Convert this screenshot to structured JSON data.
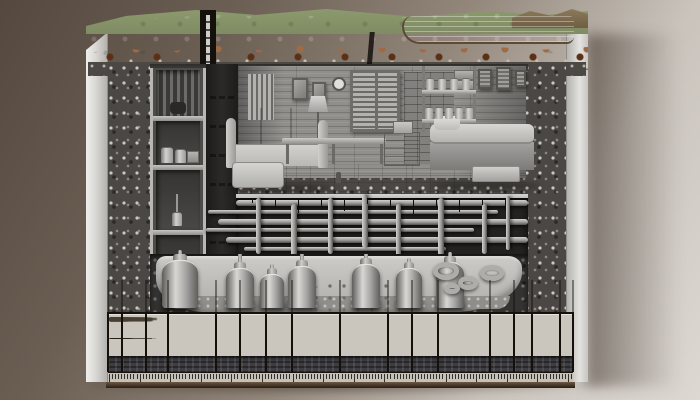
{
  "scene": {
    "description": "Photorealistic cutaway illustration of an underground bunker: grassy terrain with pond and hills on top, soil and aggregate-concrete layers, a furnished grayscale living room (couch, bed, shelves, shuttered windows, lamp), storage compartments and a vertical utility pipe shaft, a dense under-floor pipe gallery, buried storage tanks in an excavated rock trench, and a specification/legend table with a tick ruler along the base",
    "width": 700,
    "height": 400,
    "text_legibility": "all table text in the source image is illegible pseudo-text (no readable characters)"
  },
  "palette": {
    "bgTop": "#55483e",
    "bgMid": "#93877b",
    "bgBot": "#ddd8d2",
    "face": "#d9d8d5",
    "faceDark": "#b3b2af",
    "concrete": "#4b4744",
    "concreteDot": "#c9c8c5",
    "concreteDot2": "#2b2a28",
    "grass": "#a7b088",
    "grassDark": "#87966c",
    "hills": "#8d9a6e",
    "farHill": "#8d7b5c",
    "water": "#b3bfc3",
    "waterDeep": "#8da0a8",
    "shore": "#5e4936",
    "soil": "#8f5839",
    "soilDark": "#63361f",
    "stone": "#c9b9a8",
    "gravel": "#4c4843",
    "wall": "#908f8c",
    "brick": "#82817e",
    "floor": "#c7c6c3",
    "floorEdge": "#d7d6d3",
    "shutter": "#b3b2af",
    "shutterDark": "#6b6a67",
    "furn": "#b9b8b5",
    "furnLight": "#cecdc9",
    "pipeHi": "#d4d3d0",
    "pipeMid": "#989794",
    "pipeDark": "#4f4e4b",
    "pipeBg": "#232221",
    "rock": "#343331",
    "rockDot": "#6e6d6a",
    "tankHi": "#d8d7d4",
    "tankMid": "#a3a2a0",
    "tankDark": "#5f5e5b",
    "legendBg": "#cbc6bd",
    "legendLine": "#151009",
    "smudge": "#483f33",
    "band": "#3e3d42",
    "rulerBg": "#c6c1b8",
    "tick": "#332e27",
    "baseHi": "#6b5844",
    "baseDark": "#2a1d13"
  },
  "plumbing": {
    "shaft_pipes": [
      {
        "x": 4
      },
      {
        "x": 13
      },
      {
        "x": 22
      }
    ],
    "horizontal": [
      {
        "y": 2,
        "x1": 0,
        "x2": 292,
        "t": 6
      },
      {
        "y": 12,
        "x1": -28,
        "x2": 262,
        "t": 4
      },
      {
        "y": 21,
        "x1": -18,
        "x2": 292,
        "t": 6
      },
      {
        "y": 30,
        "x1": -30,
        "x2": 238,
        "t": 4
      },
      {
        "y": 39,
        "x1": -10,
        "x2": 292,
        "t": 6
      },
      {
        "y": 49,
        "x1": 8,
        "x2": 210,
        "t": 4
      }
    ],
    "vertical": [
      {
        "x": 20,
        "y1": 0,
        "y2": 56,
        "t": 5
      },
      {
        "x": 55,
        "y1": 6,
        "y2": 60,
        "t": 6
      },
      {
        "x": 92,
        "y1": 0,
        "y2": 56,
        "t": 5
      },
      {
        "x": 126,
        "y1": -4,
        "y2": 50,
        "t": 6
      },
      {
        "x": 160,
        "y1": 6,
        "y2": 60,
        "t": 5
      },
      {
        "x": 202,
        "y1": 0,
        "y2": 58,
        "t": 6
      },
      {
        "x": 246,
        "y1": 6,
        "y2": 56,
        "t": 5
      },
      {
        "x": 270,
        "y1": -2,
        "y2": 52,
        "t": 4
      }
    ],
    "hanger_rod_count": 12
  },
  "tanks": [
    {
      "x": 12,
      "w": 36,
      "h": 48,
      "drop": true
    },
    {
      "x": 76,
      "w": 28,
      "h": 40,
      "drop": true
    },
    {
      "x": 110,
      "w": 24,
      "h": 34,
      "drop": false
    },
    {
      "x": 138,
      "w": 28,
      "h": 42,
      "drop": true
    },
    {
      "x": 202,
      "w": 28,
      "h": 44,
      "drop": true
    },
    {
      "x": 246,
      "w": 26,
      "h": 40,
      "drop": false
    },
    {
      "x": 286,
      "w": 28,
      "h": 46,
      "drop": true
    }
  ],
  "rubble_pipes": [
    {
      "x": 296,
      "y": 16,
      "r": 13
    },
    {
      "x": 318,
      "y": 28,
      "r": 10
    },
    {
      "x": 342,
      "y": 18,
      "r": 12
    },
    {
      "x": 302,
      "y": 34,
      "r": 8
    }
  ],
  "wall_art": [
    {
      "x": 392,
      "y": 61,
      "w": 14,
      "h": 20
    },
    {
      "x": 410,
      "y": 59,
      "w": 15,
      "h": 23
    },
    {
      "x": 429,
      "y": 62,
      "w": 11,
      "h": 17
    }
  ],
  "supply_cans": [
    {
      "x": 340,
      "y": 70,
      "n": 4,
      "gap": 12
    },
    {
      "x": 339,
      "y": 99,
      "n": 5,
      "gap": 10
    }
  ],
  "legend": {
    "columns": [
      {
        "w": 14,
        "lines": [
          0.55,
          0.5
        ]
      },
      {
        "w": 24,
        "lines": [
          0.75,
          0.6,
          0.8
        ]
      },
      {
        "w": 22,
        "lines": [
          0.7,
          0.6,
          0.65
        ]
      },
      {
        "w": 48,
        "lines": [
          0.85,
          0.7,
          0.8,
          0.6
        ]
      },
      {
        "w": 24,
        "lines": [
          0.6,
          0.7
        ]
      },
      {
        "w": 26,
        "lines": [
          0.65,
          0.75,
          0.55
        ]
      },
      {
        "w": 26,
        "lines": [
          0.7,
          0.6,
          0.8
        ]
      },
      {
        "w": 48,
        "lines": [
          0.8,
          0.7,
          0.85,
          0.55
        ]
      },
      {
        "w": 48,
        "lines": [
          0.9,
          0.7,
          0.8,
          0.6
        ]
      },
      {
        "w": 24,
        "lines": [
          0.7,
          0.55,
          0.7
        ]
      },
      {
        "w": 26,
        "lines": [
          0.6,
          0.8,
          0.6
        ]
      },
      {
        "w": 52,
        "lines": [
          0.8,
          0.9,
          0.65,
          0.55
        ]
      },
      {
        "w": 24,
        "lines": [
          0.75,
          0.6,
          0.7
        ]
      },
      {
        "w": 18,
        "lines": [
          0.6,
          0.7,
          0.5
        ]
      },
      {
        "w": 28,
        "lines": [
          0.8,
          0.65,
          0.75,
          0.5
        ]
      },
      {
        "w": 13,
        "lines": [
          0.5,
          0.6
        ]
      }
    ]
  },
  "ruler": {
    "tick_count": 152
  }
}
